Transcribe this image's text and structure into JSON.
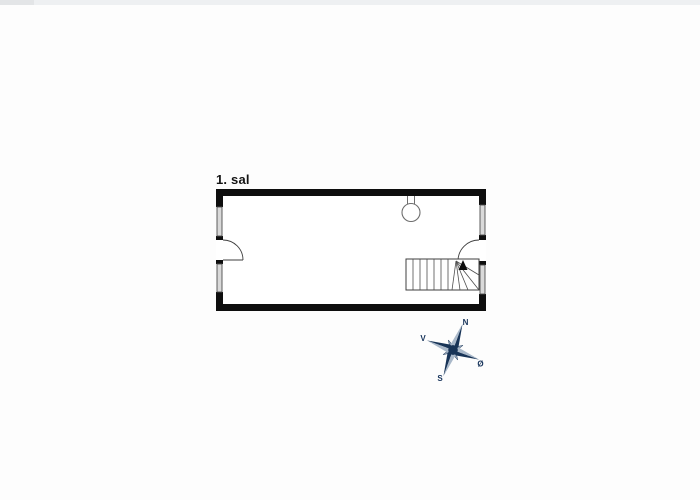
{
  "page": {
    "background": "#fdfdfd",
    "top_strip_color": "#eef0f2"
  },
  "floorplan": {
    "label": "1. sal",
    "wall_color": "#0e0e0e",
    "window_fill": "#d9d9d9",
    "symbols": {
      "lamp": "ceiling-lamp",
      "staircase": "winder-staircase-with-up-arrow",
      "doors": [
        "left-wall-door-swing",
        "right-wall-door-swing"
      ],
      "windows": [
        "left-upper",
        "left-lower",
        "right-upper",
        "right-lower"
      ]
    }
  },
  "compass": {
    "labels": {
      "north": "N",
      "west": "V",
      "east": "Ø",
      "south": "S"
    },
    "rotation_deg": 20,
    "color_dark": "#183457",
    "color_light": "#a9b8c9"
  }
}
